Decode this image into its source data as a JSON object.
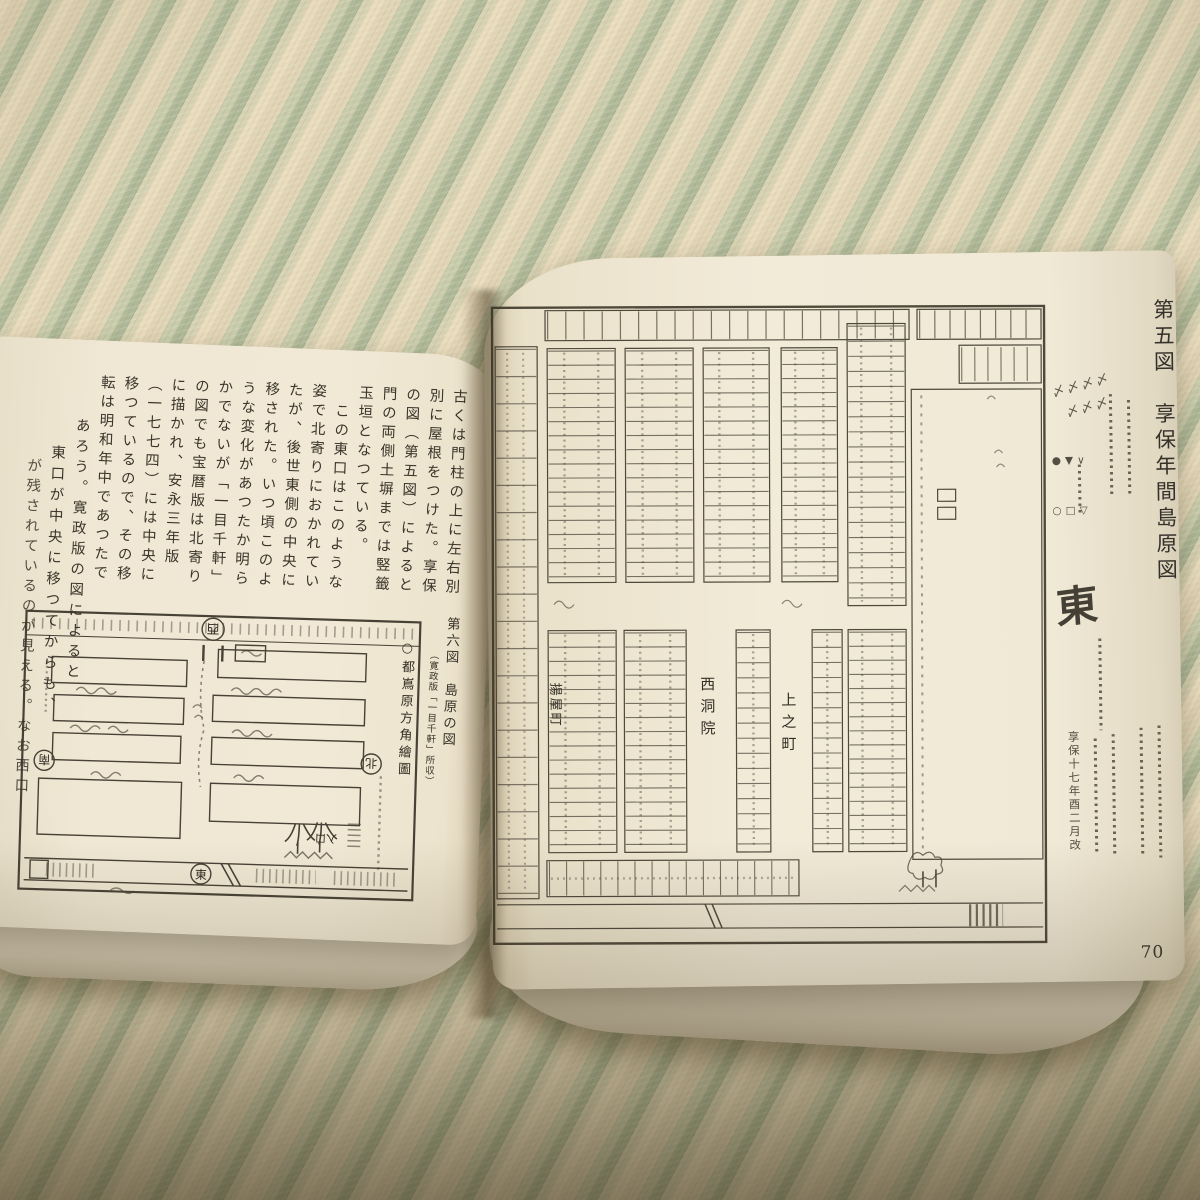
{
  "scene": {
    "description": "open book photographed on a tatami mat",
    "colors": {
      "tatami_cream": "#e9dcbc",
      "tatami_green": "#afb998",
      "paper": "#f0e8d4",
      "ink": "#3a342a",
      "shadow": "#564a2a"
    }
  },
  "left_page": {
    "columns": [
      "古くは門柱の上に左右別",
      "別に屋根をつけた。享保",
      "の図（第五図）によると",
      "門の両側土塀までは竪籤",
      "玉垣となつている。",
      "　この東口はこのような",
      "姿で北寄りにおかれてい",
      "たが、後世東側の中央に",
      "移された。いつ頃このよ",
      "うな変化があつたか明ら",
      "かでないが「一目千軒」",
      "の図でも宝暦版は北寄り",
      "に描かれ、安永三年版",
      "（一七七四）には中央に",
      "移つているので、その移",
      "転は明和年中であつたで",
      "あろう。寛政版の図によると",
      "東口が中央に移つてからも、",
      "が残されているのが見える。なお西口"
    ],
    "figure6": {
      "caption_main": "第六図　島原の図",
      "caption_sub": "（寛政版「一目千軒」所収）",
      "side_label": "○都嶌原方角繪圖",
      "compass_top": "西",
      "compass_bottom": "東",
      "compass_left": "南",
      "compass_right": "北",
      "entrance_label": "入口"
    }
  },
  "right_page": {
    "figure5_title": "第五図　享保年間島原図",
    "page_number": "70",
    "map_labels": {
      "street_1": "西洞院",
      "street_2": "上之町",
      "street_3": "揚屋町"
    },
    "margin_notes": {
      "east_mark": "東",
      "legend_row_1": "〆〆〆〆",
      "legend_row_2": "〆〆〆",
      "legend_symbols_a": "●▼∨",
      "legend_symbols_b": "○□▽",
      "date_note": "享保十七年酉二月改"
    }
  }
}
